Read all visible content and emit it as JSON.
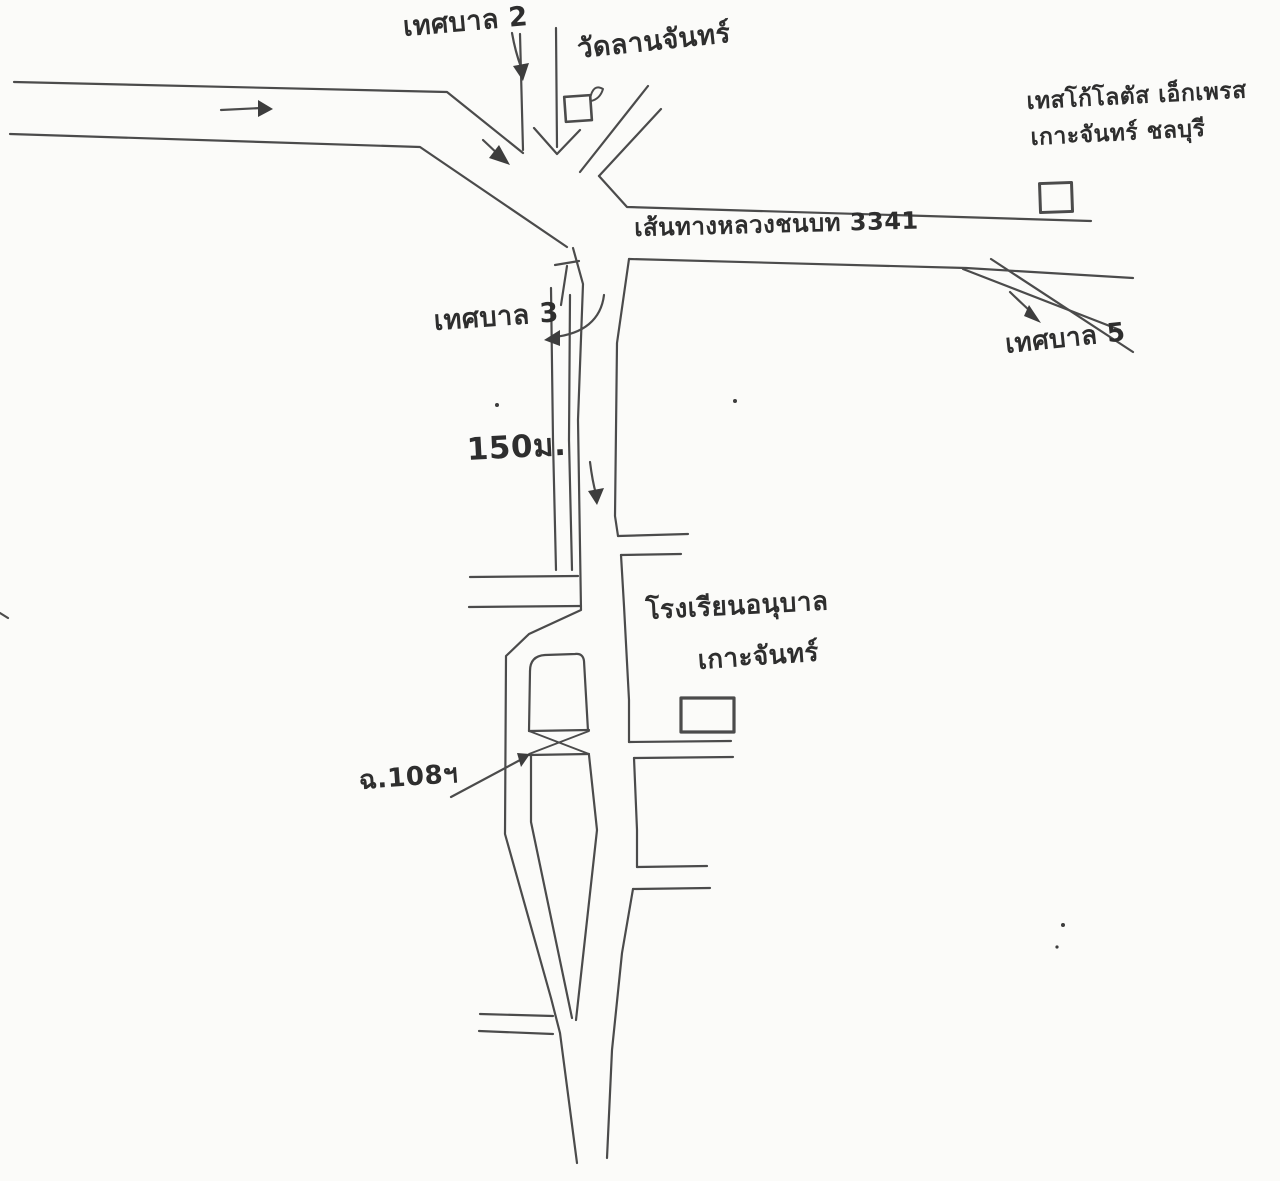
{
  "map": {
    "kind": "hand-drawn-route-sketch",
    "colors": {
      "ink": "#3d3d3d",
      "paper": "#fbfbf9"
    },
    "labels": {
      "road2": "เทศบาล 2",
      "temple": "วัดลานจันทร์",
      "store_line1": "เทสโก้โลตัส เอ็กเพรส",
      "store_line2": "เกาะจันทร์ ชลบุรี",
      "highway": "เส้นทางหลวงชนบท 3341",
      "road3": "เทศบาล 3",
      "road5": "เทศบาล 5",
      "distance": "150ม.",
      "school_line1": "โรงเรียนอนุบาล",
      "school_line2": "เกาะจันทร์",
      "bridge_ref": "ฉ.108ฯ"
    },
    "landmarks": {
      "temple_marker": "temple building",
      "store_marker": "Tesco Lotus Express building",
      "school_marker": "kindergarten school building",
      "bridge_marker": "bridge (cross-hatched)"
    }
  }
}
